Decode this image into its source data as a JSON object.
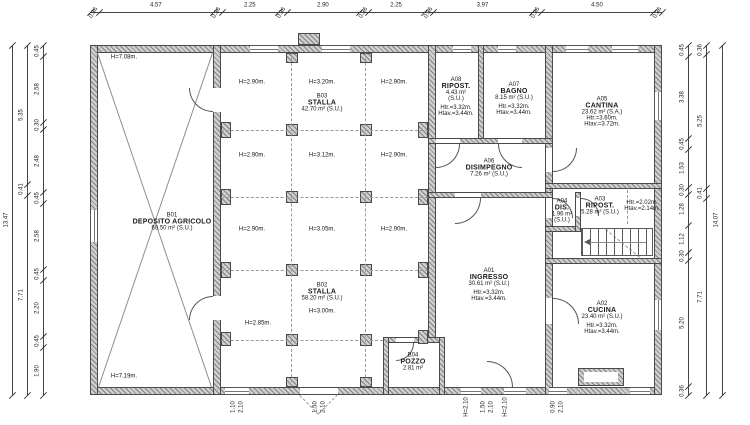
{
  "drawing_type": "architectural floor plan",
  "palette": {
    "wall_fill": "#cfcfcf",
    "wall_outline": "#4a4a4a",
    "line": "#555555",
    "dash": "#999999",
    "text": "#1a1a1a",
    "dim_text": "#222222",
    "background": "#ffffff"
  },
  "rooms": [
    {
      "id": "B01",
      "lines": [
        "B01",
        "DEPOSITO AGRICOLO",
        "60.50 m² (S.U.)"
      ],
      "cx": 172,
      "cy": 222
    },
    {
      "id": "B03",
      "lines": [
        "B03",
        "STALLA",
        "42.70 m² (S.U.)"
      ],
      "cx": 322,
      "cy": 103
    },
    {
      "id": "B02",
      "lines": [
        "B02",
        "STALLA",
        "58.20 m² (S.U.)"
      ],
      "cx": 322,
      "cy": 292
    },
    {
      "id": "B04",
      "lines": [
        "B04",
        "POZZO",
        "2.81 m²"
      ],
      "cx": 413,
      "cy": 362
    },
    {
      "id": "A01",
      "lines": [
        "A01",
        "INGRESSO",
        "30.61 m² (S.U.)",
        "",
        "Htr.=3.32m.",
        "Htav.=3.44m."
      ],
      "cx": 489,
      "cy": 285
    },
    {
      "id": "A06",
      "lines": [
        "A06",
        "DISIMPEGNO",
        "7.26 m² (S.U.)"
      ],
      "cx": 489,
      "cy": 168
    },
    {
      "id": "A08",
      "lines": [
        "A08",
        "RIPOST.",
        "4.43 m²",
        "(S.U.)",
        "",
        "Htr.=3.32m.",
        "Htav.=3.44m."
      ],
      "cx": 456,
      "cy": 97
    },
    {
      "id": "A07",
      "lines": [
        "A07",
        "BAGNO",
        "8.15 m² (S.U.)",
        "",
        "Htr.=3.32m.",
        "Htav.=3.44m."
      ],
      "cx": 514,
      "cy": 99
    },
    {
      "id": "A05",
      "lines": [
        "A05",
        "CANTINA",
        "23.62 m² (S.A.)",
        "Htr.=3.60m.",
        "Htav.=3.72m."
      ],
      "cx": 602,
      "cy": 112
    },
    {
      "id": "A04",
      "lines": [
        "A04",
        "DIS.",
        "1.96 m²",
        "(S.U.)"
      ],
      "cx": 562,
      "cy": 211
    },
    {
      "id": "A03",
      "lines": [
        "A03",
        "RIPOST.",
        "5.28 m² (S.U.)"
      ],
      "cx": 600,
      "cy": 206
    },
    {
      "id": "A03-note",
      "small": true,
      "lines": [
        "Htr.=2.02m.",
        "Htav.=2.14m."
      ],
      "cx": 642,
      "cy": 206
    },
    {
      "id": "A02",
      "lines": [
        "A02",
        "CUCINA",
        "23.40 m² (S.U.)",
        "",
        "Htr.=3.32m.",
        "Htav.=3.44m."
      ],
      "cx": 602,
      "cy": 318
    }
  ],
  "height_labels": [
    {
      "x": 252,
      "y": 83,
      "t": "H=2.90m."
    },
    {
      "x": 322,
      "y": 83,
      "t": "H=3.20m."
    },
    {
      "x": 394,
      "y": 83,
      "t": "H=2.90m."
    },
    {
      "x": 252,
      "y": 156,
      "t": "H=2.90m."
    },
    {
      "x": 322,
      "y": 156,
      "t": "H=3.12m."
    },
    {
      "x": 394,
      "y": 156,
      "t": "H=2.90m."
    },
    {
      "x": 252,
      "y": 230,
      "t": "H=2.90m."
    },
    {
      "x": 322,
      "y": 230,
      "t": "H=3.05m."
    },
    {
      "x": 394,
      "y": 230,
      "t": "H=2.90m."
    },
    {
      "x": 322,
      "y": 312,
      "t": "H=3.00m."
    },
    {
      "x": 258,
      "y": 324,
      "t": "H=2.85m."
    },
    {
      "x": 124,
      "y": 58,
      "t": "H=7.08m."
    },
    {
      "x": 124,
      "y": 377,
      "t": "H=7.19m."
    }
  ],
  "structure": {
    "walls": [
      [
        90,
        45,
        572,
        8
      ],
      [
        90,
        387,
        572,
        8
      ],
      [
        90,
        45,
        8,
        350
      ],
      [
        654,
        45,
        8,
        350
      ],
      [
        213,
        45,
        8,
        350
      ],
      [
        428,
        45,
        8,
        298
      ],
      [
        545,
        45,
        8,
        350
      ],
      [
        478,
        45,
        6,
        96
      ],
      [
        428,
        138,
        125,
        6
      ],
      [
        428,
        192,
        125,
        6
      ],
      [
        545,
        183,
        117,
        6
      ],
      [
        545,
        226,
        36,
        6
      ],
      [
        575,
        192,
        6,
        40
      ],
      [
        545,
        258,
        117,
        6
      ],
      [
        383,
        337,
        62,
        6
      ],
      [
        383,
        337,
        6,
        58
      ],
      [
        439,
        337,
        6,
        58
      ]
    ],
    "chimney": [
      298,
      33,
      22,
      12
    ],
    "gaps": [
      [
        213,
        88,
        8,
        24
      ],
      [
        213,
        296,
        8,
        24
      ],
      [
        436,
        139,
        24,
        4
      ],
      [
        498,
        139,
        24,
        4
      ],
      [
        455,
        193,
        26,
        4
      ],
      [
        546,
        148,
        6,
        24
      ],
      [
        546,
        198,
        6,
        20
      ],
      [
        576,
        198,
        4,
        18
      ],
      [
        546,
        298,
        6,
        26
      ],
      [
        396,
        338,
        18,
        4
      ],
      [
        300,
        388,
        38,
        6
      ]
    ],
    "windows": [
      {
        "x": 250,
        "y": 45,
        "w": 28,
        "h": 8,
        "o": "h"
      },
      {
        "x": 322,
        "y": 45,
        "w": 28,
        "h": 8,
        "o": "h"
      },
      {
        "x": 453,
        "y": 45,
        "w": 18,
        "h": 8,
        "o": "h"
      },
      {
        "x": 498,
        "y": 45,
        "w": 18,
        "h": 8,
        "o": "h"
      },
      {
        "x": 566,
        "y": 45,
        "w": 22,
        "h": 8,
        "o": "h"
      },
      {
        "x": 612,
        "y": 45,
        "w": 26,
        "h": 8,
        "o": "h"
      },
      {
        "x": 225,
        "y": 387,
        "w": 24,
        "h": 8,
        "o": "h"
      },
      {
        "x": 461,
        "y": 387,
        "w": 20,
        "h": 8,
        "o": "h"
      },
      {
        "x": 504,
        "y": 387,
        "w": 22,
        "h": 8,
        "o": "h"
      },
      {
        "x": 549,
        "y": 387,
        "w": 18,
        "h": 8,
        "o": "h"
      },
      {
        "x": 630,
        "y": 387,
        "w": 20,
        "h": 8,
        "o": "h"
      },
      {
        "x": 90,
        "y": 210,
        "w": 8,
        "h": 32,
        "o": "v"
      },
      {
        "x": 654,
        "y": 92,
        "w": 8,
        "h": 28,
        "o": "v"
      },
      {
        "x": 654,
        "y": 300,
        "w": 8,
        "h": 30,
        "o": "v"
      }
    ],
    "pilasters": [
      [
        221,
        122,
        10,
        16
      ],
      [
        221,
        189,
        10,
        16
      ],
      [
        221,
        262,
        10,
        16
      ],
      [
        221,
        332,
        10,
        14
      ],
      [
        418,
        122,
        10,
        16
      ],
      [
        418,
        189,
        10,
        16
      ],
      [
        418,
        262,
        10,
        16
      ],
      [
        418,
        330,
        10,
        14
      ],
      [
        286,
        124,
        12,
        12
      ],
      [
        360,
        124,
        12,
        12
      ],
      [
        286,
        191,
        12,
        12
      ],
      [
        360,
        191,
        12,
        12
      ],
      [
        286,
        264,
        12,
        12
      ],
      [
        360,
        264,
        12,
        12
      ],
      [
        286,
        334,
        12,
        12
      ],
      [
        360,
        334,
        12,
        12
      ],
      [
        286,
        53,
        12,
        10
      ],
      [
        360,
        53,
        12,
        10
      ],
      [
        286,
        377,
        12,
        10
      ],
      [
        360,
        377,
        12,
        10
      ]
    ],
    "dashes": [
      {
        "x1": 292,
        "y1": 53,
        "x2": 292,
        "y2": 387
      },
      {
        "x1": 366,
        "y1": 53,
        "x2": 366,
        "y2": 387
      },
      {
        "x1": 221,
        "y1": 130,
        "x2": 428,
        "y2": 130
      },
      {
        "x1": 221,
        "y1": 197,
        "x2": 428,
        "y2": 197
      },
      {
        "x1": 221,
        "y1": 270,
        "x2": 428,
        "y2": 270
      },
      {
        "x1": 221,
        "y1": 340,
        "x2": 383,
        "y2": 340
      },
      {
        "x1": 628,
        "y1": 190,
        "x2": 628,
        "y2": 224
      },
      {
        "x1": 606,
        "y1": 229,
        "x2": 640,
        "y2": 257
      },
      {
        "x1": 300,
        "y1": 395,
        "x2": 319,
        "y2": 414
      },
      {
        "x1": 338,
        "y1": 395,
        "x2": 319,
        "y2": 414
      }
    ],
    "solids": [
      {
        "x1": 98,
        "y1": 53,
        "x2": 212,
        "y2": 387
      },
      {
        "x1": 98,
        "y1": 387,
        "x2": 212,
        "y2": 53
      }
    ],
    "arcs": [
      {
        "x": 436,
        "y": 144,
        "r": 24,
        "c": "br"
      },
      {
        "x": 498,
        "y": 144,
        "r": 24,
        "c": "bl"
      },
      {
        "x": 455,
        "y": 198,
        "r": 26,
        "c": "br"
      },
      {
        "x": 553,
        "y": 148,
        "r": 24,
        "c": "br"
      },
      {
        "x": 553,
        "y": 198,
        "r": 20,
        "c": "tr"
      },
      {
        "x": 581,
        "y": 198,
        "r": 18,
        "c": "tr"
      },
      {
        "x": 553,
        "y": 298,
        "r": 26,
        "c": "tr"
      },
      {
        "x": 487,
        "y": 361,
        "r": 26,
        "c": "tr"
      },
      {
        "x": 189,
        "y": 88,
        "r": 24,
        "c": "bl"
      },
      {
        "x": 189,
        "y": 296,
        "r": 24,
        "c": "tl"
      },
      {
        "x": 396,
        "y": 343,
        "r": 18,
        "c": "br"
      }
    ],
    "stairs": {
      "x": 581,
      "y": 228,
      "w": 72,
      "h": 28
    },
    "stair_arrow": {
      "x1": 590,
      "y1": 242,
      "x2": 646,
      "y2": 242
    },
    "fireplace": {
      "outer": [
        578,
        368,
        46,
        18
      ],
      "inner": [
        584,
        372,
        34,
        10
      ]
    }
  },
  "dimensions": {
    "top": {
      "y": 12,
      "x0": 90,
      "x1": 662,
      "values": [
        "0.36",
        "4.57",
        "0.36",
        "2.25",
        "0.36",
        "2.90",
        "0.36",
        "2.25",
        "0.36",
        "3.97",
        "0.36",
        "4.50",
        "0.36"
      ]
    },
    "left": [
      {
        "x": 12,
        "y0": 45,
        "y1": 395,
        "values": [
          "13.47"
        ]
      },
      {
        "x": 27,
        "y0": 45,
        "y1": 395,
        "values": [
          "5.35",
          "0.41",
          "7.71"
        ]
      },
      {
        "x": 43,
        "y0": 45,
        "y1": 395,
        "values": [
          "0.45",
          "2.58",
          "0.30",
          "2.48",
          "0.45",
          "2.58",
          "0.45",
          "2.20",
          "0.45",
          "1.90"
        ]
      }
    ],
    "right": [
      {
        "x": 688,
        "y0": 45,
        "y1": 395,
        "values": [
          "0.45",
          "3.38",
          "0.45",
          "1.53",
          "0.30",
          "1.28",
          "1.12",
          "0.30",
          "5.20",
          "0.36"
        ]
      },
      {
        "x": 706,
        "y0": 45,
        "y1": 395,
        "values": [
          "0.36",
          "5.25",
          "0.41",
          "7.71"
        ]
      },
      {
        "x": 722,
        "y0": 45,
        "y1": 395,
        "values": [
          "14.07"
        ]
      }
    ],
    "bottom_notes": [
      {
        "x": 234,
        "t": "1.10"
      },
      {
        "x": 242,
        "t": "2.10"
      },
      {
        "x": 316,
        "t": "1.50"
      },
      {
        "x": 324,
        "t": "2.10"
      },
      {
        "x": 467,
        "t": "H=2.10"
      },
      {
        "x": 484,
        "t": "1.50"
      },
      {
        "x": 492,
        "t": "2.10"
      },
      {
        "x": 506,
        "t": "H=2.10"
      },
      {
        "x": 554,
        "t": "0.90"
      },
      {
        "x": 562,
        "t": "2.10"
      }
    ]
  }
}
